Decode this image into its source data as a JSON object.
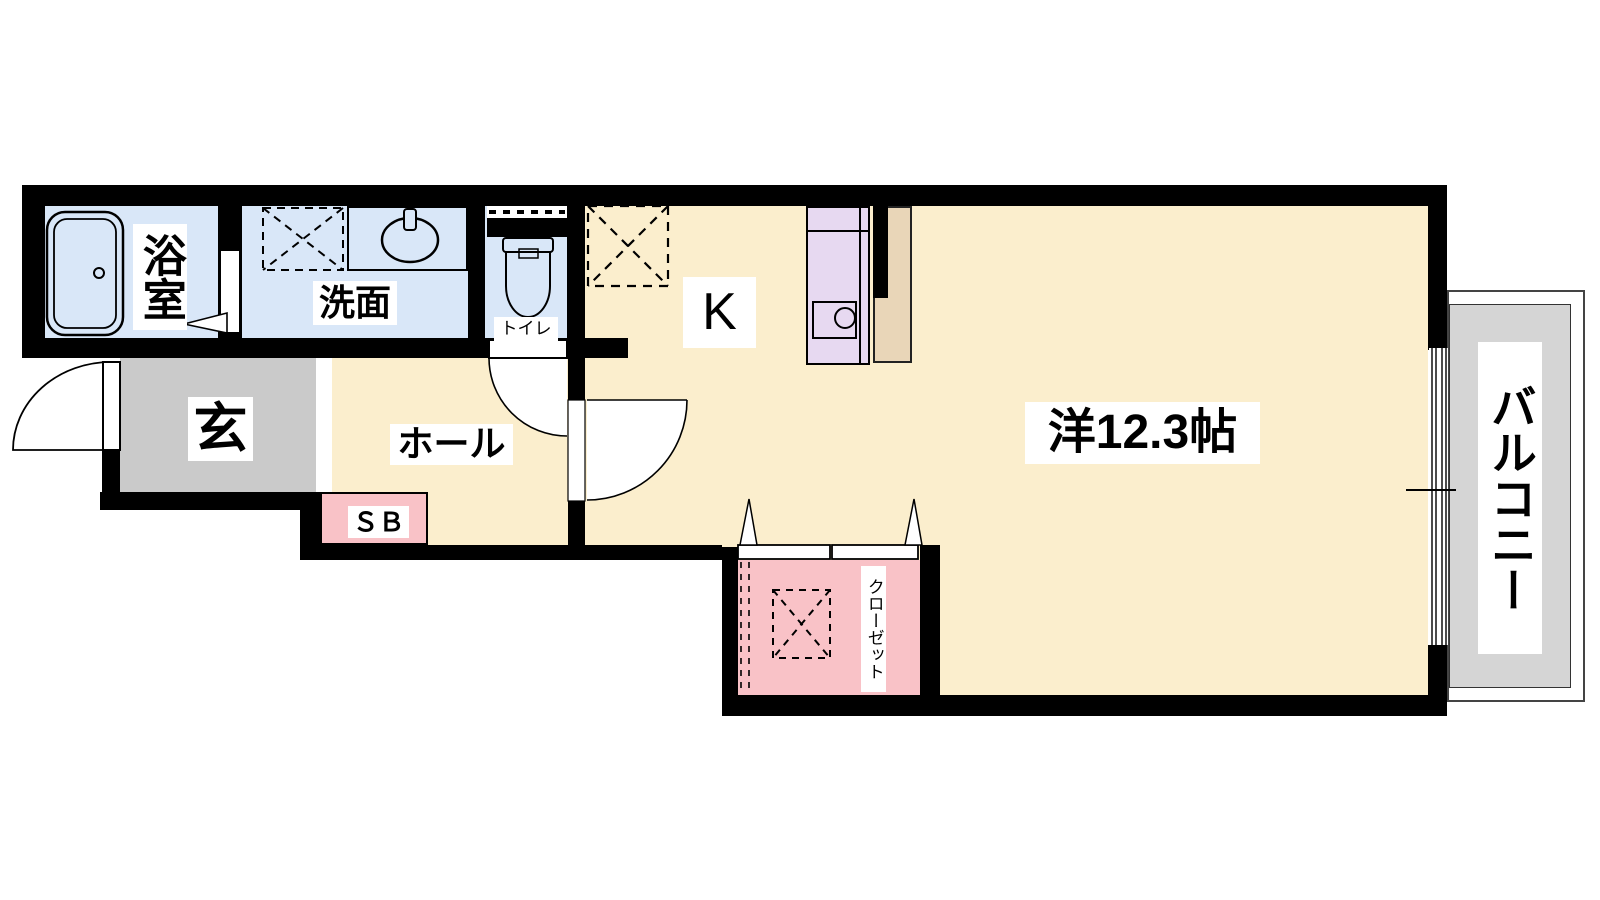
{
  "floorplan": {
    "type_note": "1K apartment floor plan",
    "rooms": {
      "bathroom": {
        "label": "浴室"
      },
      "washroom": {
        "label": "洗面"
      },
      "toilet": {
        "label": "トイレ"
      },
      "kitchen": {
        "label": "K"
      },
      "entrance": {
        "label": "玄"
      },
      "hall": {
        "label": "ホール"
      },
      "shoebox": {
        "label": "ＳＢ"
      },
      "main_room": {
        "label": "洋12.3帖",
        "area_tatami": "12.3"
      },
      "closet": {
        "label": "クローゼット"
      },
      "balcony": {
        "label": "バルコニー"
      }
    },
    "colors": {
      "wall": "#000000",
      "wet_room_fill": "#d9e7f8",
      "living_fill": "#fbeecd",
      "entrance_fill": "#cacaca",
      "closet_fill": "#f9c2c7",
      "kitchen_counter_fill": "#e7d9f1",
      "appliance_fill": "#e9d6b8",
      "balcony_fill": "#d5d5d5",
      "label_bg": "#ffffff"
    }
  }
}
